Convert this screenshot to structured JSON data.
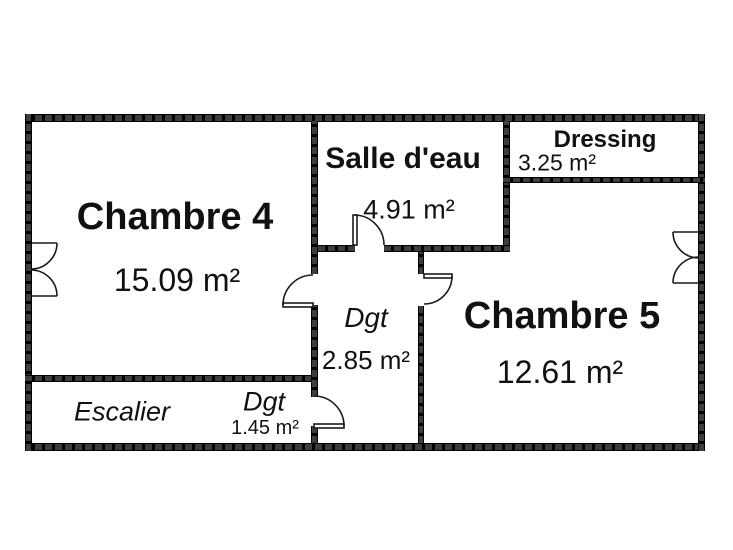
{
  "colors": {
    "wall": "#3a3a3a",
    "text": "#111111",
    "background": "#ffffff"
  },
  "rooms": {
    "chambre4": {
      "name": "Chambre 4",
      "area": "15.09 m²"
    },
    "salle_deau": {
      "name": "Salle d'eau",
      "area": "4.91 m²"
    },
    "dressing": {
      "name": "Dressing",
      "area": "3.25 m²"
    },
    "chambre5": {
      "name": "Chambre 5",
      "area": "12.61 m²"
    },
    "degagement_milieu": {
      "name": "Dgt",
      "area": "2.85 m²"
    },
    "escalier": {
      "name": "Escalier"
    },
    "degagement_bas": {
      "name": "Dgt",
      "area": "1.45 m²"
    }
  }
}
